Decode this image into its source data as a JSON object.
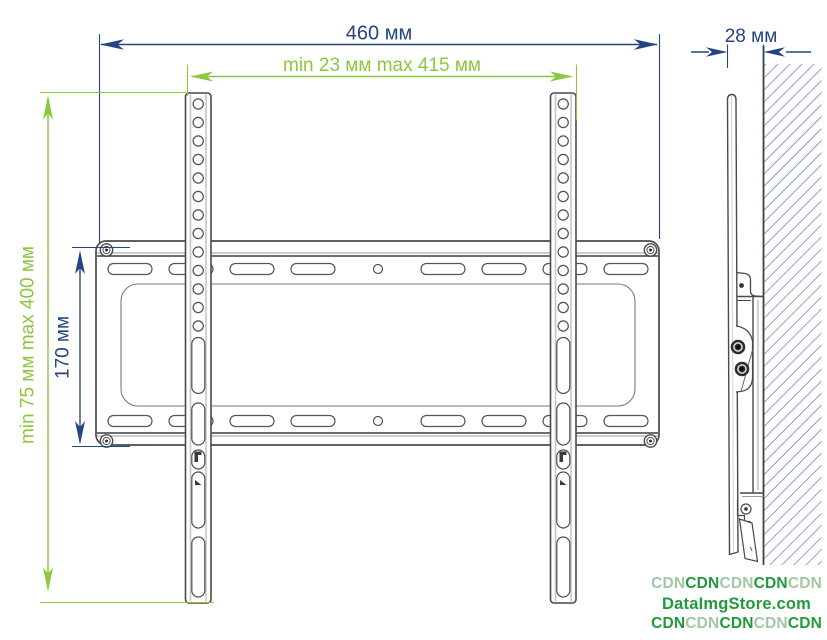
{
  "dimensions": {
    "total_width": "460 мм",
    "horizontal_pattern": "min 23 мм max 415 мм",
    "depth": "28 мм",
    "vertical_pattern": "min 75 мм max 400 мм",
    "plate_height": "170 мм"
  },
  "colors": {
    "dimension_blue": "#24467f",
    "dimension_green": "#8dc63f",
    "outline_gray": "#4a4a4a",
    "hatch_blue": "#5b6ca6",
    "watermark_dark_green": "#219a3b",
    "watermark_light_green": "#a4c7a3"
  },
  "watermark": {
    "rows": [
      {
        "segments": [
          {
            "text": "CDN",
            "tone": "wm-light"
          },
          {
            "text": "CDN",
            "tone": "wm-dark"
          },
          {
            "text": "CDN",
            "tone": "wm-light"
          },
          {
            "text": "CDN",
            "tone": "wm-dark"
          },
          {
            "text": "CDN",
            "tone": "wm-light"
          }
        ]
      },
      {
        "segments": [
          {
            "text": "DataImgStore.com",
            "tone": "wm-dark"
          }
        ]
      },
      {
        "segments": [
          {
            "text": "CDN",
            "tone": "wm-dark"
          },
          {
            "text": "CDN",
            "tone": "wm-light"
          },
          {
            "text": "CDN",
            "tone": "wm-dark"
          },
          {
            "text": "CDN",
            "tone": "wm-light"
          },
          {
            "text": "CDN",
            "tone": "wm-dark"
          }
        ]
      }
    ]
  }
}
